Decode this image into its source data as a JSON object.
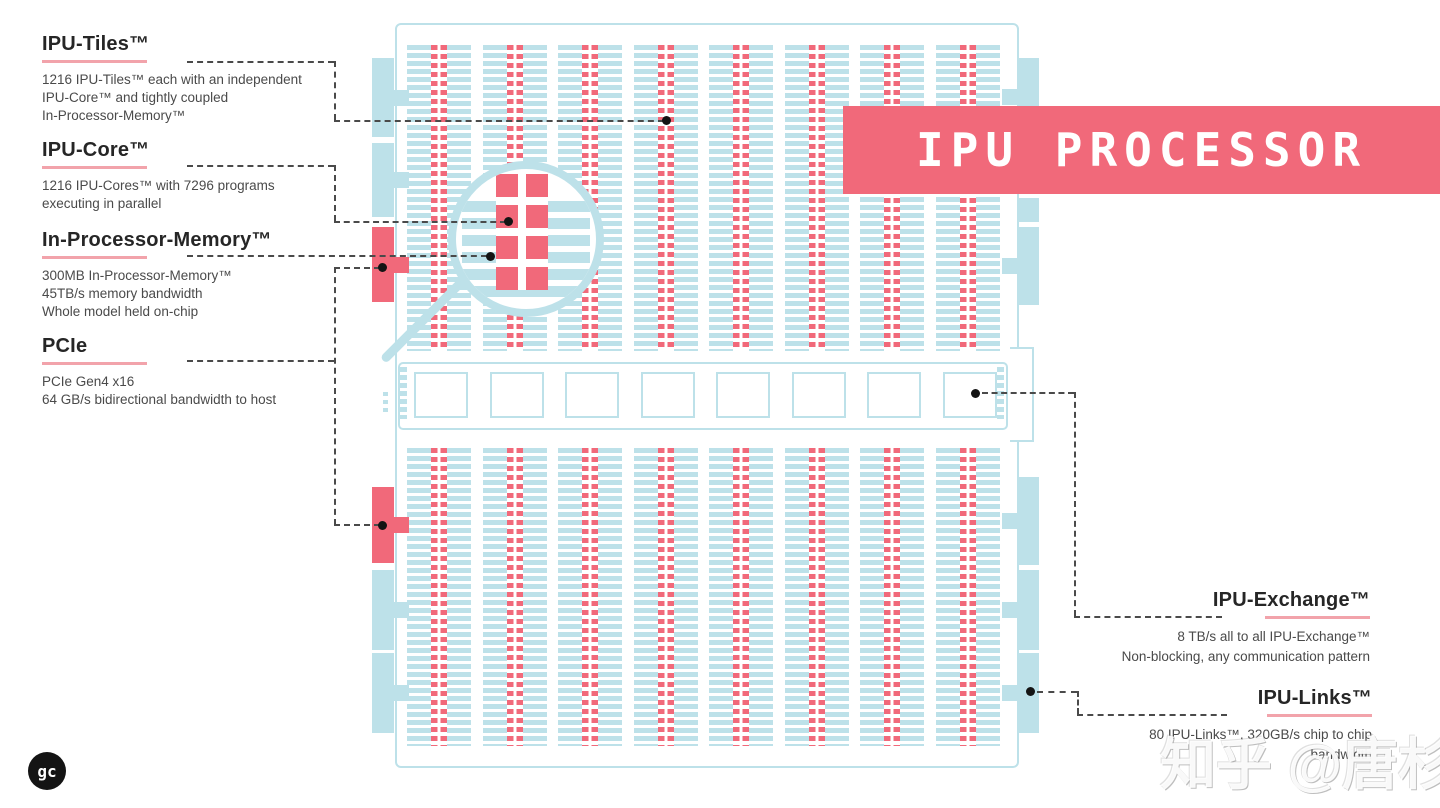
{
  "banner": {
    "title": "IPU PROCESSOR",
    "color": "#F1697A",
    "text_color": "#ffffff"
  },
  "annotations_left": [
    {
      "title": "IPU-Tiles™",
      "desc": [
        "1216 IPU-Tiles™ each with an independent",
        "IPU-Core™ and tightly coupled",
        "In-Processor-Memory™"
      ]
    },
    {
      "title": "IPU-Core™",
      "desc": [
        "1216 IPU-Cores™ with 7296 programs",
        "executing in parallel"
      ]
    },
    {
      "title": "In-Processor-Memory™",
      "desc": [
        "300MB In-Processor-Memory™",
        "45TB/s memory bandwidth",
        "Whole model held on-chip"
      ]
    },
    {
      "title": "PCIe",
      "desc": [
        "PCIe Gen4 x16",
        "64 GB/s bidirectional bandwidth to host"
      ]
    }
  ],
  "annotations_right": [
    {
      "title": "IPU-Exchange™",
      "desc": [
        "8 TB/s all to all IPU-Exchange™",
        "Non-blocking, any communication pattern"
      ]
    },
    {
      "title": "IPU-Links™",
      "desc": [
        "80 IPU-Links™, 320GB/s chip to chip",
        "bandwidth"
      ]
    }
  ],
  "diagram": {
    "column_groups_per_half": 8,
    "halves": 2,
    "exchange_squares": 8,
    "colors": {
      "tile_blue": "#BDE1E9",
      "core_red": "#F1697A",
      "underline_pink": "#F2A3AB",
      "connector_dash": "#4a4a4a"
    }
  },
  "watermark": {
    "text": "知乎 @唐杉"
  },
  "logo": {
    "text": "gc"
  }
}
